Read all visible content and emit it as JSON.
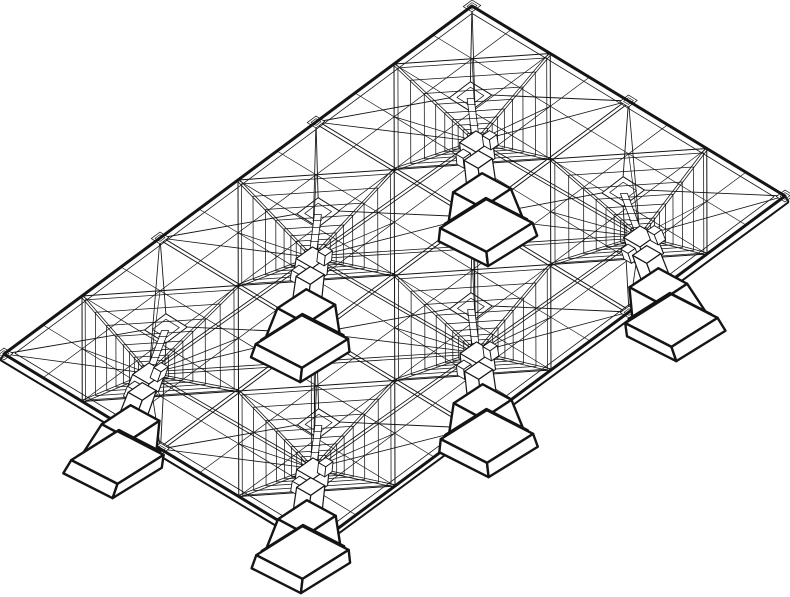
{
  "diagram": {
    "kind": "wireframe-axonometric-structure",
    "subject": "space-frame canopy roof of pyramidal umbrella modules on pedestal columns",
    "background": "#ffffff",
    "ink": "#151515",
    "fill_white": "#ffffff",
    "view": {
      "width": 790,
      "height": 597
    },
    "proj": {
      "origin": [
        472,
        6
      ],
      "axis_a": [
        -156,
        116
      ],
      "axis_b": [
        156.5,
        95
      ],
      "x_center": 395,
      "depth_x_flare": 0.0016
    },
    "grid": {
      "a_modules": 3,
      "b_modules": 2,
      "subdiv": [
        0.25,
        0.5,
        0.75
      ]
    },
    "roof": {
      "edge_stroke": 3.0,
      "inset": 0.035,
      "inset_stroke": 0.8,
      "fascia_drop": 6,
      "fascia_stroke": 2.0,
      "valley_gap": 1.7,
      "valley_stroke": 0.95,
      "grid_stroke": 0.7,
      "node_plate_half": 0.028,
      "node_plate_inner": 0.016,
      "node_plate_stroke": 0.7
    },
    "cap": {
      "z": 15,
      "half": 0.07,
      "inner_half": 0.044,
      "stroke": 1.0,
      "hip_stroke": 0.9
    },
    "kingpost": {
      "top_z": 13,
      "bottom_z": -27,
      "half_px": 3.5,
      "tick_levels": [
        7,
        0,
        -7,
        -14,
        -21
      ],
      "tick_half_px": 4.6,
      "stroke": 0.8
    },
    "web": {
      "hub_z": -30,
      "hub_half": 0.05,
      "hub_inner_half": 0.03,
      "hub_stroke": 1.0,
      "rings": [
        0.06,
        0.1,
        0.15,
        0.21,
        0.28,
        0.37,
        0.48,
        0.62,
        0.79,
        0.95
      ],
      "ring_stroke": 0.75,
      "base_stroke": 1.0,
      "ridge_gap": 1.2,
      "ridge_stroke": 0.8,
      "corner_spoke_stroke": 0.85,
      "quarter_spoke_stroke": 0.7,
      "chord_gap": 1.5,
      "chord_stroke": 0.85,
      "diag_chord_stroke": 0.8
    },
    "column": {
      "head_half": 0.05,
      "head_top": -30,
      "head_bottom": -48,
      "head_stroke": 1.1,
      "corbel_half": 0.022,
      "corbel_offset": 0.08,
      "corbel_top": -33,
      "corbel_bottom": -43,
      "corbel_stroke": 0.9,
      "shaft_half": 0.042,
      "shaft_top": -48,
      "shaft_bottom": -79,
      "shaft_stroke": 1.2
    },
    "pedestal": {
      "stroke": 2.4,
      "upper": {
        "top": -79,
        "bottom": -110,
        "half_top": 0.082,
        "half_bottom": 0.102
      },
      "step": {
        "top": -110,
        "bottom": -114,
        "half_top": 0.112,
        "half_bottom": 0.115
      },
      "base": {
        "top": -114,
        "bottom": -127,
        "half_top": 0.125,
        "half_bottom": 0.131
      }
    }
  }
}
